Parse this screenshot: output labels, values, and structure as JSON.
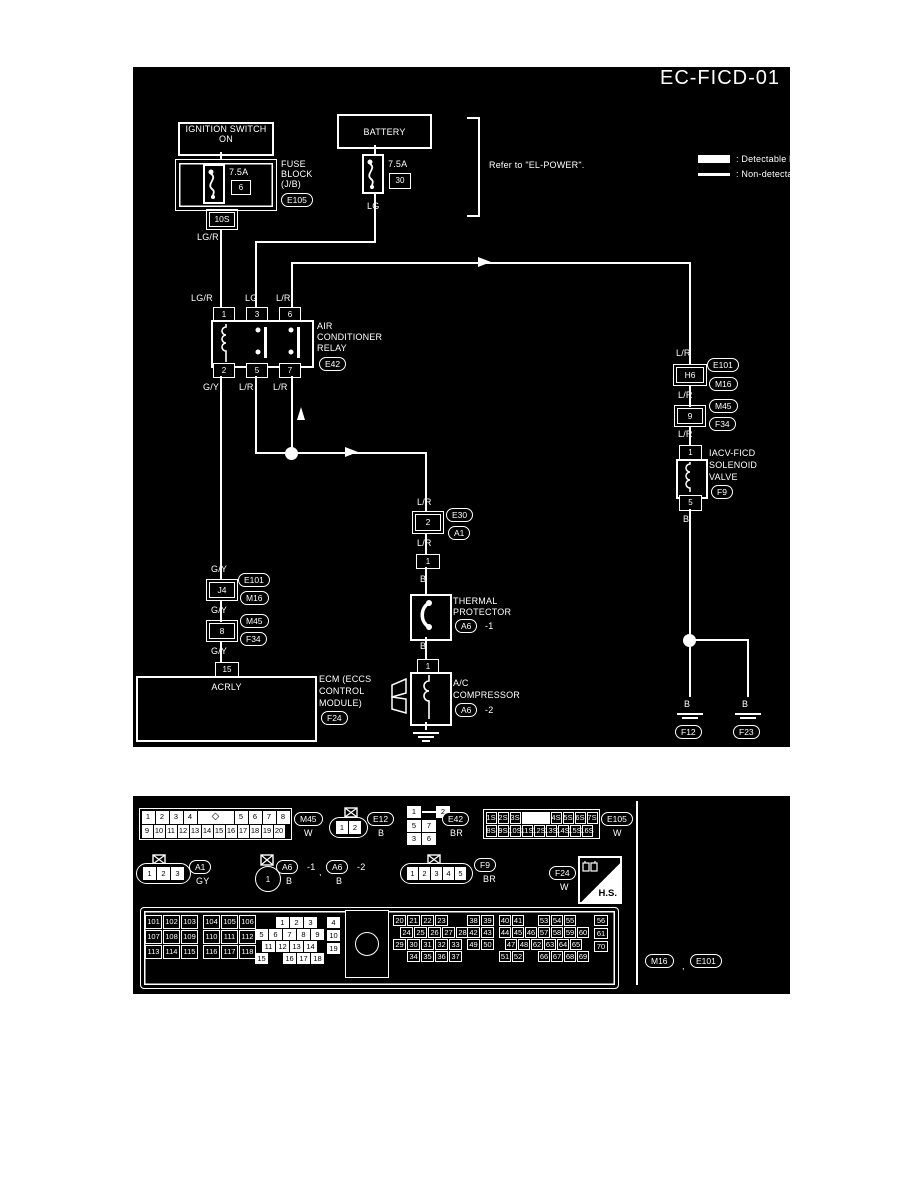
{
  "colors": {
    "background": "#000000",
    "foreground": "#ffffff"
  },
  "diagram": {
    "title": "EC-FICD-01",
    "legend": {
      "detectable": ": Detectable line for DTC",
      "non_detectable": ": Non-detectable line for DTC"
    },
    "refer_note": "Refer to \"EL-POWER\".",
    "ignition_switch": {
      "line1": "IGNITION SWITCH",
      "line2": "ON"
    },
    "battery": "BATTERY",
    "fuse_block": {
      "name1": "FUSE",
      "name2": "BLOCK",
      "name3": "(J/B)",
      "connector": "E105",
      "fuse_rating": "7.5A",
      "fuse_number": "6",
      "splice": "10S",
      "wire_out": "LG/R"
    },
    "battery_fuse": {
      "rating": "7.5A",
      "number": "30",
      "wire_out": "LG"
    },
    "relay": {
      "name1": "AIR",
      "name2": "CONDITIONER",
      "name3": "RELAY",
      "connector": "E42",
      "pin1": "1",
      "pin3": "3",
      "pin6": "6",
      "pin2": "2",
      "pin5": "5",
      "pin7": "7",
      "wire_pin1": "LG/R",
      "wire_pin3": "LG",
      "wire_pin6": "L/R",
      "wire_pin2": "G/Y",
      "wire_pin5": "L/R",
      "wire_pin7": "L/R"
    },
    "left_chain": {
      "wire1": "G/Y",
      "splice1": "J4",
      "splice1_conn_a": "E101",
      "splice1_conn_b": "M16",
      "wire2": "G/Y",
      "splice2": "8",
      "splice2_conn_a": "M45",
      "splice2_conn_b": "F34",
      "wire3": "G/Y",
      "ecm_pin": "15",
      "ecm_signal": "ACRLY",
      "ecm1": "ECM (ECCS",
      "ecm2": "CONTROL",
      "ecm3": "MODULE)",
      "ecm_connector": "F24"
    },
    "middle_chain": {
      "wire1": "L/R",
      "splice": "2",
      "splice_conn_a": "E30",
      "splice_conn_b": "A1",
      "wire2": "L/R",
      "tp_pin": "1",
      "wire3": "B",
      "tp1": "THERMAL",
      "tp2": "PROTECTOR",
      "tp_connector": "A6",
      "tp_suffix": "-1",
      "wire4": "B",
      "comp_pin": "1",
      "comp1": "A/C",
      "comp2": "COMPRESSOR",
      "comp_connector": "A6",
      "comp_suffix": "-2"
    },
    "right_chain": {
      "wire1": "L/R",
      "splice1": "H6",
      "splice1_conn_a": "E101",
      "splice1_conn_b": "M16",
      "wire2": "L/R",
      "splice2": "9",
      "splice2_conn_a": "M45",
      "splice2_conn_b": "F34",
      "wire3": "L/R",
      "valve_pin_top": "1",
      "valve1": "IACV-FICD",
      "valve2": "SOLENOID",
      "valve3": "VALVE",
      "valve_connector": "F9",
      "valve_pin_bottom": "5",
      "wire4": "B",
      "ground1_wire": "B",
      "ground1": "F12",
      "ground2_wire": "B",
      "ground2": "F23"
    }
  },
  "connectors": {
    "m45": {
      "id": "M45",
      "color": "W",
      "row1": [
        "1",
        "2",
        "3",
        "4",
        "◇",
        "5",
        "6",
        "7",
        "8"
      ],
      "row2": [
        "9",
        "10",
        "11",
        "12",
        "13",
        "14",
        "15",
        "16",
        "17",
        "18",
        "19",
        "20"
      ]
    },
    "e12": {
      "id": "E12",
      "color": "B",
      "pins": [
        "1",
        "2"
      ]
    },
    "e42": {
      "id": "E42",
      "color": "BR",
      "top": [
        "1",
        "2"
      ],
      "mid": [
        "5",
        "7"
      ],
      "bottom": [
        "3",
        "6"
      ]
    },
    "e105": {
      "id": "E105",
      "color": "W",
      "row1": [
        "1S",
        "2S",
        "3S",
        "",
        "4S",
        "5S",
        "6S",
        "7S"
      ],
      "row2": [
        "8S",
        "9S",
        "10S",
        "11S",
        "12S",
        "13S",
        "14S",
        "15S",
        "16S"
      ]
    },
    "a1": {
      "id": "A1",
      "color": "GY",
      "pins": [
        "1",
        "2",
        "3"
      ]
    },
    "a6": {
      "id": "A6",
      "pin": "1",
      "suffix1": "-1",
      "comma": ",",
      "suffix2": "-2",
      "color1": "B",
      "color2": "B"
    },
    "f9": {
      "id": "F9",
      "color": "BR",
      "pins": [
        "1",
        "2",
        "3",
        "4",
        "5"
      ]
    },
    "f24": {
      "id": "F24",
      "color": "W"
    },
    "hs_label": "H.S.",
    "ecm": {
      "block1": [
        [
          "101",
          "102",
          "103"
        ],
        [
          "107",
          "108",
          "109"
        ],
        [
          "113",
          "114",
          "115"
        ]
      ],
      "block2": [
        [
          "104",
          "105",
          "106"
        ],
        [
          "110",
          "111",
          "112"
        ],
        [
          "116",
          "117",
          "118"
        ]
      ],
      "block3": [
        [
          "1",
          "2",
          "3"
        ],
        [
          "5",
          "6",
          "7",
          "8",
          "9"
        ],
        [
          "11",
          "12",
          "13",
          "14"
        ],
        [
          "15",
          "",
          "16",
          "17",
          "18"
        ]
      ],
      "block3_side": [
        "4",
        "10",
        "19"
      ],
      "block4": [
        [
          "20",
          "21",
          "22",
          "23"
        ],
        [
          "24",
          "25",
          "26",
          "27",
          "28"
        ],
        [
          "29",
          "30",
          "31",
          "32",
          "33"
        ],
        [
          "34",
          "35",
          "36",
          "37"
        ]
      ],
      "block5": [
        [
          "38",
          "39"
        ],
        [
          "42",
          "43"
        ],
        [
          "49",
          "50"
        ]
      ],
      "block6": [
        [
          "40",
          "41",
          "",
          "53",
          "54",
          "55"
        ],
        [
          "44",
          "45",
          "46",
          "57",
          "58",
          "59",
          "60"
        ],
        [
          "47",
          "48",
          "62",
          "63",
          "64",
          "65"
        ],
        [
          "51",
          "52",
          "",
          "66",
          "67",
          "68",
          "69"
        ]
      ],
      "block7": [
        "56",
        "61",
        "70"
      ]
    },
    "footer": {
      "a": "M16",
      "comma": ",",
      "b": "E101"
    }
  }
}
